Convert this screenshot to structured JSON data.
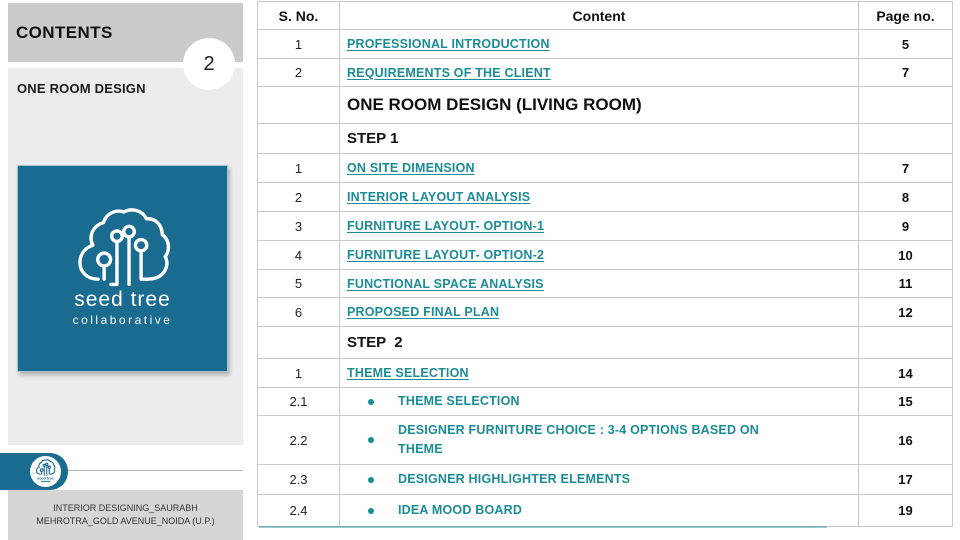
{
  "sidebar": {
    "title": "CONTENTS",
    "page_number": "2",
    "section_label": "ONE ROOM DESIGN",
    "logo": {
      "line1": "seed tree",
      "line2": "collaborative"
    },
    "footer_line1": "INTERIOR DESIGNING_SAURABH",
    "footer_line2": "MEHROTRA_GOLD AVENUE_NOIDA (U.P.)"
  },
  "colors": {
    "teal_link": "#1b8c96",
    "logo_bg": "#1a6b90",
    "sidebar_block_dark": "#cbcbcb",
    "sidebar_block_light": "#ececec",
    "footer_bg": "#d6d6d6",
    "table_border": "#c9c9c9"
  },
  "table": {
    "headers": {
      "sno": "S. No.",
      "content": "Content",
      "page": "Page no."
    },
    "rows": [
      {
        "type": "link",
        "sno": "1",
        "content": "PROFESSIONAL INTRODUCTION",
        "page": "5"
      },
      {
        "type": "link",
        "sno": "2",
        "content": "REQUIREMENTS OF THE CLIENT",
        "page": "7"
      },
      {
        "type": "section",
        "sno": "",
        "content": "ONE ROOM DESIGN (LIVING ROOM)",
        "page": ""
      },
      {
        "type": "step",
        "sno": "",
        "content": "STEP 1",
        "page": ""
      },
      {
        "type": "link",
        "sno": "1",
        "content": "ON SITE DIMENSION",
        "page": "7"
      },
      {
        "type": "link",
        "sno": "2",
        "content": "INTERIOR LAYOUT ANALYSIS",
        "page": "8"
      },
      {
        "type": "link",
        "sno": "3",
        "content": "FURNITURE LAYOUT- OPTION-1",
        "page": "9"
      },
      {
        "type": "link",
        "sno": "4",
        "content": "FURNITURE LAYOUT- OPTION-2",
        "page": "10"
      },
      {
        "type": "link",
        "sno": "5",
        "content": "FUNCTIONAL SPACE ANALYSIS",
        "page": "11"
      },
      {
        "type": "link",
        "sno": "6",
        "content": "PROPOSED FINAL PLAN",
        "page": "12"
      },
      {
        "type": "step",
        "sno": "",
        "content": "STEP  2",
        "page": ""
      },
      {
        "type": "link",
        "sno": "1",
        "content": "THEME SELECTION",
        "page": "14"
      },
      {
        "type": "bullet",
        "sno": "2.1",
        "content": "THEME SELECTION",
        "page": "15"
      },
      {
        "type": "bullet",
        "sno": "2.2",
        "content": "DESIGNER FURNITURE CHOICE : 3-4 OPTIONS BASED ON THEME",
        "page": "16"
      },
      {
        "type": "bullet",
        "sno": "2.3",
        "content": "DESIGNER HIGHLIGHTER ELEMENTS",
        "page": "17"
      },
      {
        "type": "bullet",
        "sno": "2.4",
        "content": "IDEA MOOD BOARD",
        "page": "19"
      }
    ]
  }
}
